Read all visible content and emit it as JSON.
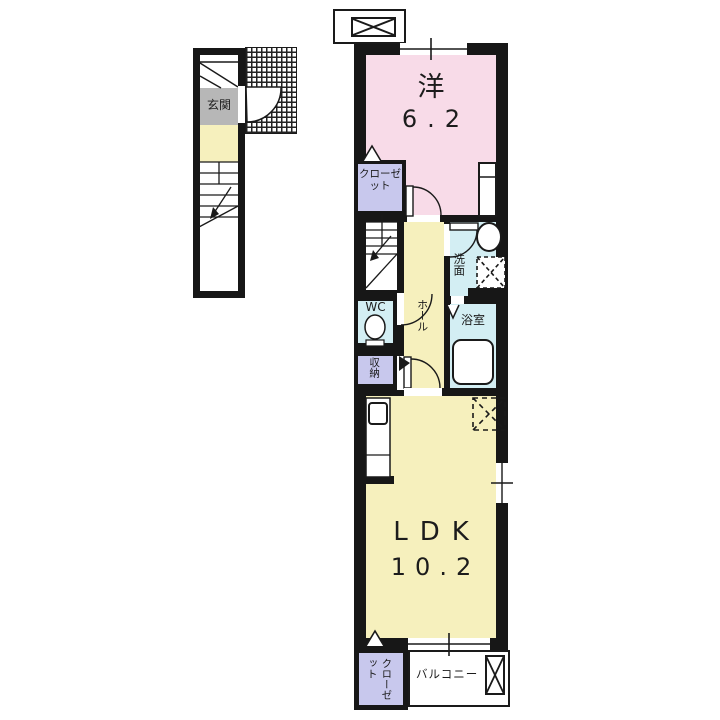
{
  "plan_title": "apartment-floor-plan",
  "colors": {
    "wall": "#171717",
    "pink": "#f8dbe8",
    "yellow": "#f6f0bd",
    "cyan": "#d3eef3",
    "lavender": "#c8c8ed",
    "gray": "#b7b7b7"
  },
  "left_block": {
    "entrance_label": "玄関"
  },
  "unit": {
    "western_room": {
      "name": "洋",
      "size": "6.2"
    },
    "closet_upper": {
      "label": "クローゼット"
    },
    "wc": {
      "label": "WC"
    },
    "hall": {
      "label": "ホール"
    },
    "washroom": {
      "label": "洗面"
    },
    "bathroom": {
      "label": "浴室"
    },
    "storage": {
      "label": "収納"
    },
    "ldk": {
      "name": "LDK",
      "size": "10.2"
    },
    "closet_lower": {
      "label": "クローゼット"
    },
    "balcony": {
      "label": "バルコニー"
    }
  }
}
